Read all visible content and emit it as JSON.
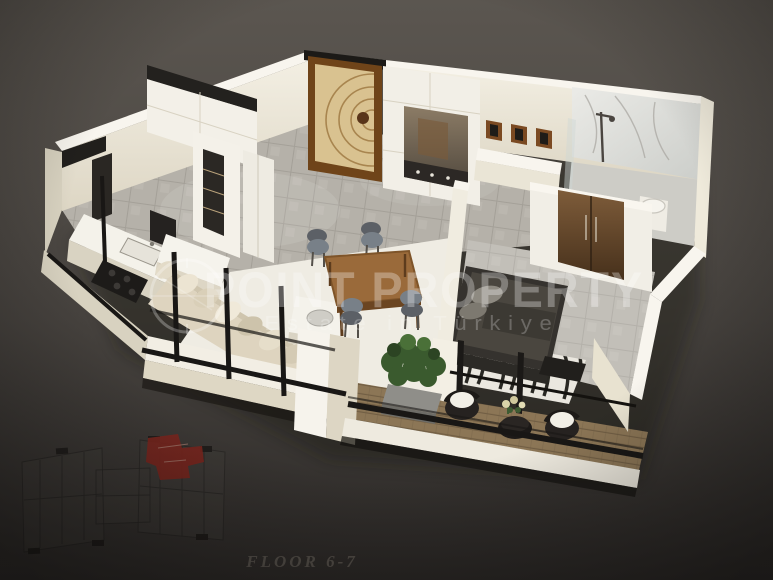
{
  "watermark": {
    "brand": "POINT PROPERTY",
    "tagline": "Estate in Türkiye",
    "logo": "compass-circle-icon"
  },
  "caption": {
    "floor_label": "FLOOR 6-7"
  },
  "key_plan": {
    "highlight_color": "#a01a10"
  },
  "colors": {
    "background_top": "#5b5650",
    "background_mid": "#46423e",
    "background_bottom": "#2b2826",
    "wall_cream": "#f1ede1",
    "wall_edge": "#f8f5ee",
    "wall_shade": "#d8d2c0",
    "floor_tile": "#b5b1a9",
    "rug_white": "#efece3",
    "deck_wood": "#8c7656",
    "door_wood": "#6f4419",
    "door_panel": "#d9c290",
    "sofa_beige": "#ded4bf",
    "bed_charcoal": "#35322e",
    "mirror_brown": "#6b4a2e",
    "plant_green": "#3a5a2e",
    "wicker_dark": "#262220",
    "accent_black": "#1b1917",
    "key_plan_red": "#a01a10",
    "key_plan_line": "#1b1918",
    "watermark_white": "#ffffff",
    "caption_gray": "#56514b"
  }
}
